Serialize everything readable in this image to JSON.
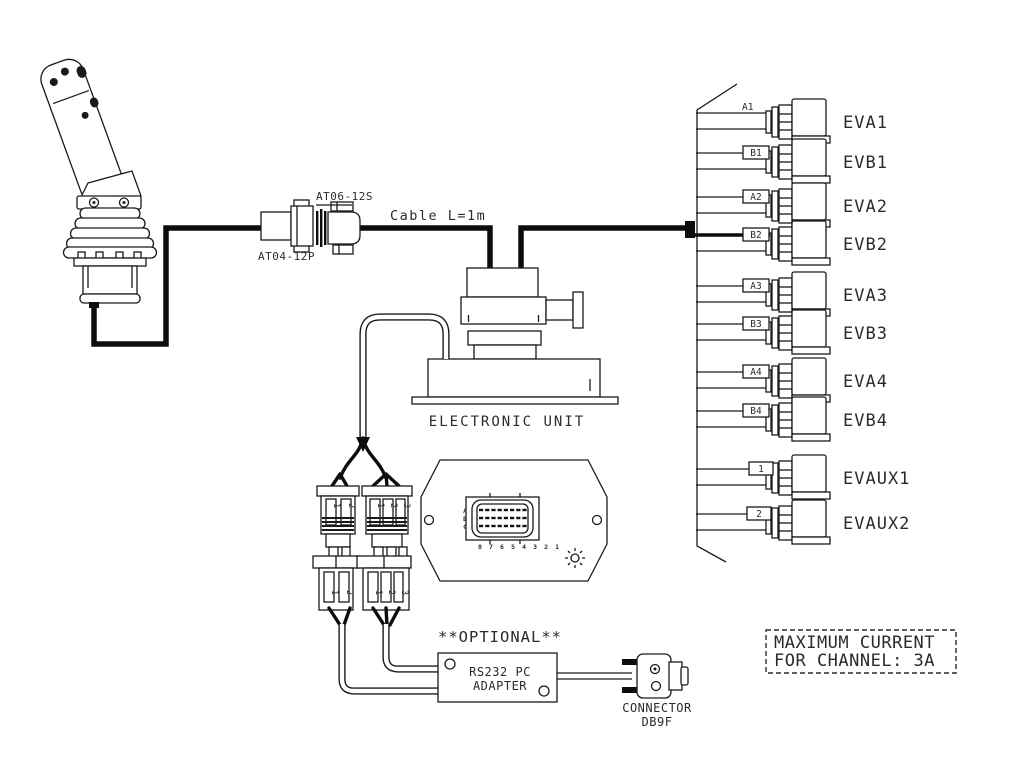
{
  "colors": {
    "line": "#1a1a1a",
    "cable": "#0d0d0d",
    "background": "#ffffff"
  },
  "joystick_cable": {
    "plug_label": "AT04-12P",
    "socket_label": "AT06-12S",
    "cable_label": "Cable L=1m"
  },
  "unit": {
    "label": "ELECTRONIC UNIT"
  },
  "controller": {
    "rows": [
      "A",
      "B",
      "C"
    ],
    "cols": "8 7 6 5 4 3 2 1"
  },
  "splitter": {
    "left_pins": [
      "1",
      "2"
    ],
    "right_pins": [
      "1",
      "2",
      "3"
    ]
  },
  "valve_rows": [
    {
      "tag": "A1",
      "name": "EVA1",
      "boxed": false,
      "bold": false
    },
    {
      "tag": "B1",
      "name": "EVB1",
      "boxed": true,
      "bold": false
    },
    {
      "tag": "A2",
      "name": "EVA2",
      "boxed": true,
      "bold": false
    },
    {
      "tag": "B2",
      "name": "EVB2",
      "boxed": true,
      "bold": true
    },
    {
      "tag": "A3",
      "name": "EVA3",
      "boxed": true,
      "bold": false
    },
    {
      "tag": "B3",
      "name": "EVB3",
      "boxed": true,
      "bold": false
    },
    {
      "tag": "A4",
      "name": "EVA4",
      "boxed": true,
      "bold": false
    },
    {
      "tag": "B4",
      "name": "EVB4",
      "boxed": true,
      "bold": false
    },
    {
      "tag": "1",
      "name": "EVAUX1",
      "boxed": true,
      "bold": false
    },
    {
      "tag": "2",
      "name": "EVAUX2",
      "boxed": true,
      "bold": false
    }
  ],
  "optional": {
    "label": "**OPTIONAL**"
  },
  "adapter": {
    "line1": "RS232 PC",
    "line2": "ADAPTER"
  },
  "db9": {
    "line1": "CONNECTOR",
    "line2": "DB9F"
  },
  "max_current": {
    "line1": "MAXIMUM CURRENT",
    "line2": "FOR CHANNEL: 3A"
  }
}
